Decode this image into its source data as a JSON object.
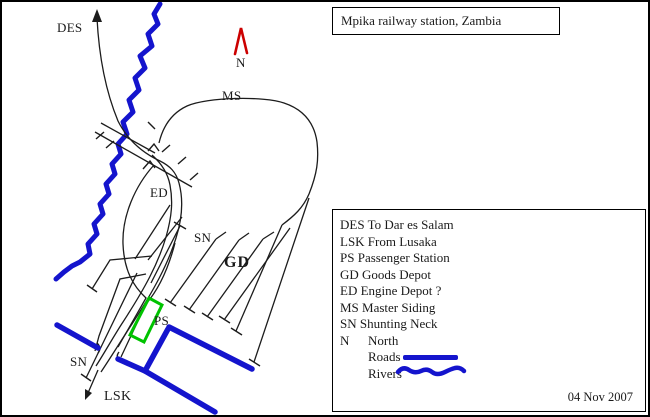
{
  "title": {
    "text": "Mpika railway station, Zambia"
  },
  "map": {
    "labels": {
      "des": "DES",
      "north": "N",
      "ms": "MS",
      "ed": "ED",
      "sn_top": "SN",
      "gd": "GD",
      "ps": "PS",
      "sn_bottom": "SN",
      "lsk": "LSK"
    }
  },
  "legend": {
    "items": [
      "DES To Dar es Salam",
      "LSK From Lusaka",
      "PS Passenger Station",
      "GD Goods Depot",
      "ED Engine Depot ?",
      "MS Master Siding",
      "SN Shunting Neck"
    ],
    "north_abbr": "N",
    "north_label": "North",
    "roads_label": "Roads",
    "rivers_label": "Rivers"
  },
  "date": "04 Nov 2007",
  "colors": {
    "line": "#1c1c1c",
    "blue": "#1414cd",
    "green": "#00c300",
    "red": "#cc0000"
  }
}
